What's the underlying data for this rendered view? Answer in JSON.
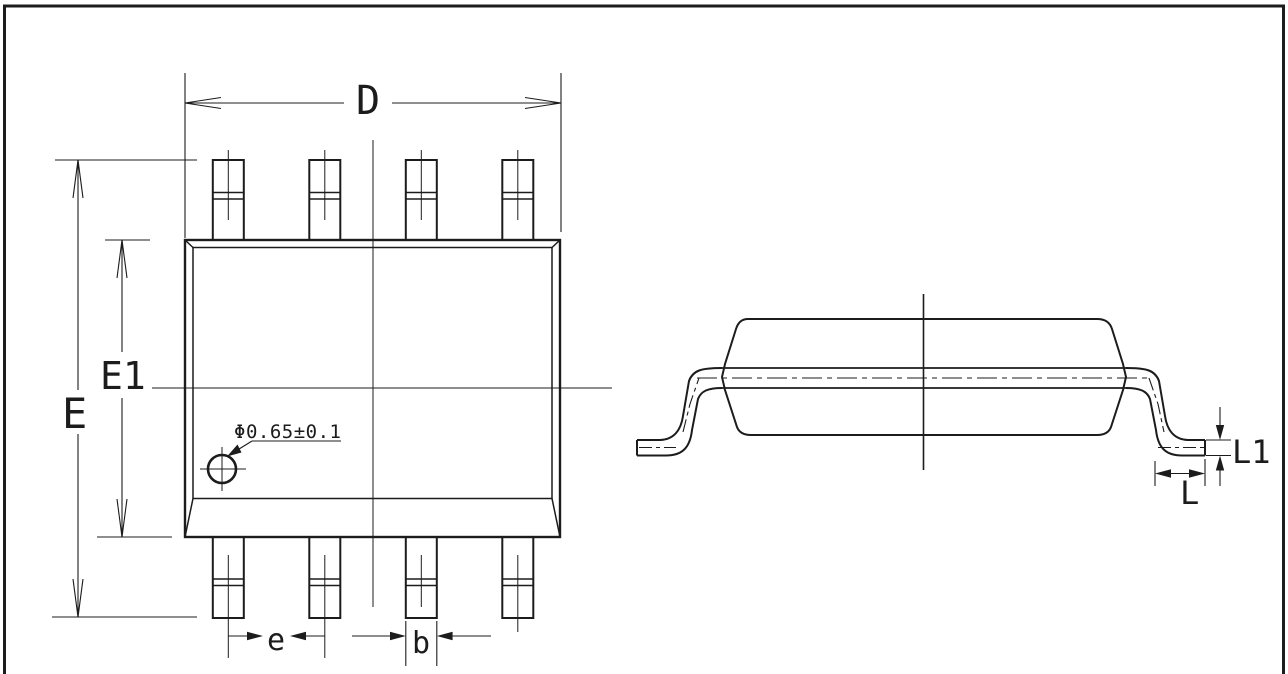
{
  "drawing": {
    "top_view": {
      "dim_width_label": "D",
      "dim_overall_span_label": "E",
      "dim_body_span_label": "E1",
      "dim_pitch_label": "e",
      "dim_lead_width_label": "b",
      "pin1_marker_label": "Φ0.65±0.1"
    },
    "side_view": {
      "dim_foot_length_label": "L",
      "dim_foot_height_label": "L1"
    },
    "colors": {
      "line": "#1c1c1c",
      "background": "#ffffff"
    }
  }
}
